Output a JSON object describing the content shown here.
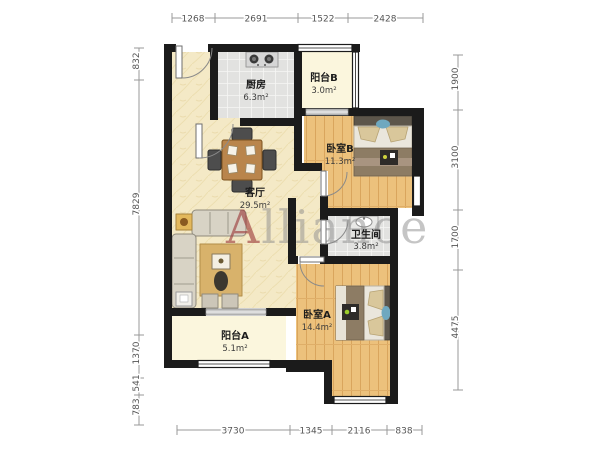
{
  "watermark": {
    "lead": "A",
    "rest": "lliance"
  },
  "rooms": {
    "kitchen": {
      "name": "厨房",
      "area": "6.3m²"
    },
    "balcony_b": {
      "name": "阳台B",
      "area": "3.0m²"
    },
    "bedroom_b": {
      "name": "卧室B",
      "area": "11.3m²"
    },
    "living": {
      "name": "客厅",
      "area": "29.5m²"
    },
    "bathroom": {
      "name": "卫生间",
      "area": "3.8m²"
    },
    "bedroom_a": {
      "name": "卧室A",
      "area": "14.4m²"
    },
    "balcony_a": {
      "name": "阳台A",
      "area": "5.1m²"
    }
  },
  "dimensions": {
    "top": {
      "d1": "1268",
      "d2": "2691",
      "d3": "1522",
      "d4": "2428"
    },
    "bottom": {
      "d1": "3730",
      "d2": "1345",
      "d3": "2116",
      "d4": "838"
    },
    "left": {
      "d1": "832",
      "d2": "7829",
      "d3": "1370",
      "d4": "541",
      "d5": "783"
    },
    "right": {
      "d1": "1900",
      "d2": "3100",
      "d3": "1700",
      "d4": "4475"
    }
  },
  "colors": {
    "wall": "#1b1b1b",
    "wood_floor": "#ecc17c",
    "living_floor": "#f4e9c6",
    "tile_floor": "#e2e2e0",
    "balcony_floor": "#fbf6dd",
    "watermark_lead": "#9c3a3a",
    "watermark_rest": "#8d8d8d"
  }
}
